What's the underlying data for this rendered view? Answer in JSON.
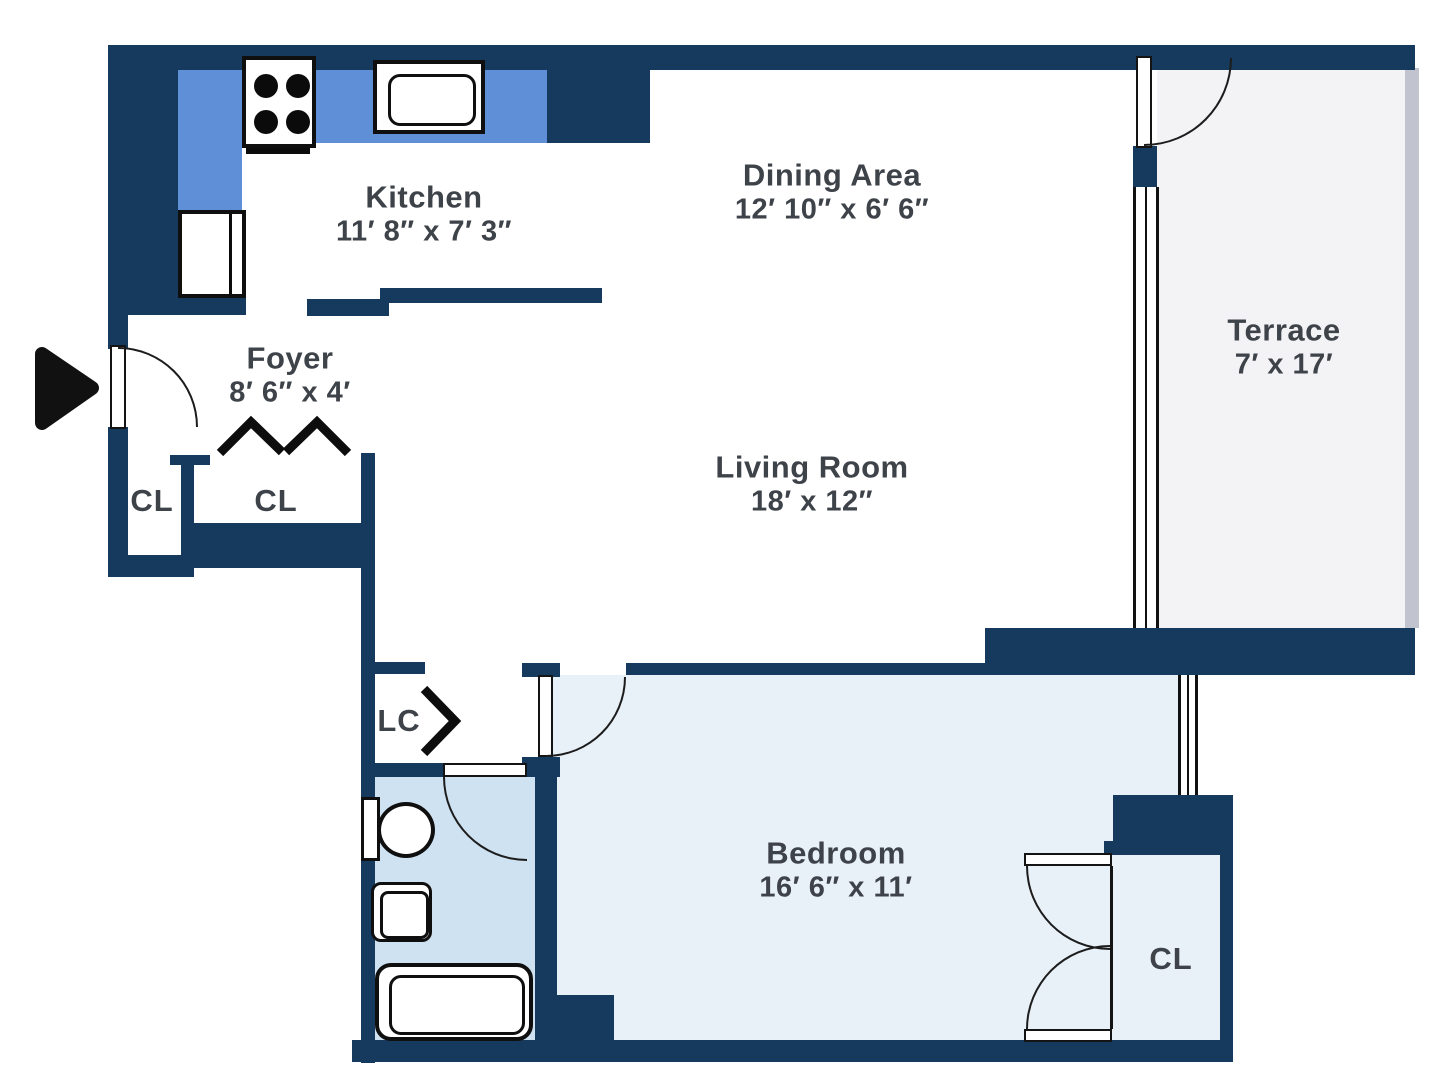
{
  "plan_type": "apartment-floor-plan",
  "rooms": {
    "kitchen": {
      "name": "Kitchen",
      "dimensions": "11′ 8″  x  7′ 3″"
    },
    "dining": {
      "name": "Dining Area",
      "dimensions": "12′ 10″ x  6′ 6″"
    },
    "terrace": {
      "name": "Terrace",
      "dimensions": "7′ x 17′"
    },
    "foyer": {
      "name": "Foyer",
      "dimensions": "8′ 6″ x 4′"
    },
    "living": {
      "name": "Living Room",
      "dimensions": "18′ x 12″"
    },
    "bedroom": {
      "name": "Bedroom",
      "dimensions": "16′ 6″ x 11′"
    },
    "closet_foyer_left": {
      "name": "CL"
    },
    "closet_foyer_right": {
      "name": "CL"
    },
    "linen_closet": {
      "name": "LC"
    },
    "closet_bedroom": {
      "name": "CL"
    }
  },
  "icons": {
    "entry_arrow": "entry-arrow-icon",
    "bifold_doors": "zigzag-bifold-doors-icon",
    "accordion_door": "chevron-accordion-door-icon",
    "stove": "stove-burners-icon",
    "kitchen_sink": "kitchen-sink-icon",
    "refrigerator": "refrigerator-icon",
    "toilet": "toilet-icon",
    "bathroom_sink": "bathroom-sink-icon",
    "bathtub": "bathtub-icon"
  },
  "colors": {
    "wall": "#16395e",
    "counter": "#5f8fd6",
    "bathroom_fill": "#cfe2f2",
    "bedroom_fill": "#e9f1f8",
    "terrace_fill": "#f3f3f5",
    "terrace_edge": "#c1c4cf",
    "line": "#141414",
    "text": "#3e434a",
    "background": "#ffffff"
  }
}
